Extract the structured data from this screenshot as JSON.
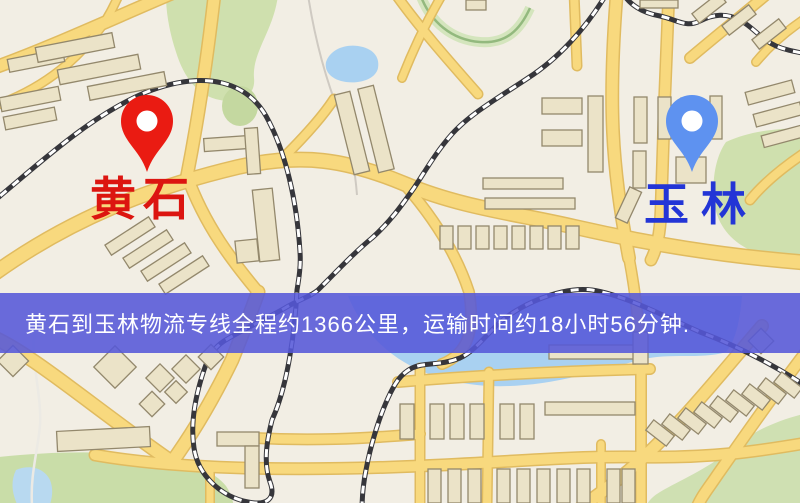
{
  "banner": {
    "text": "黄石到玉林物流专线全程约1366公里，运输时间约18小时56分钟.",
    "background_color": "#5558d8",
    "text_color": "#ffffff"
  },
  "origin": {
    "name": "黄石",
    "pin_color": "#ea1b12",
    "label_color": "#dc1510"
  },
  "destination": {
    "name": "玉林",
    "pin_color": "#5e92f0",
    "label_color": "#2335d6"
  },
  "map_colors": {
    "background": "#f2eee4",
    "road_fill": "#f8d97e",
    "road_border": "#e0bb60",
    "building": "#ebe3c8",
    "green_area": "#cfe0ae",
    "water": "#a9d1f1",
    "railway": "#36363b"
  }
}
